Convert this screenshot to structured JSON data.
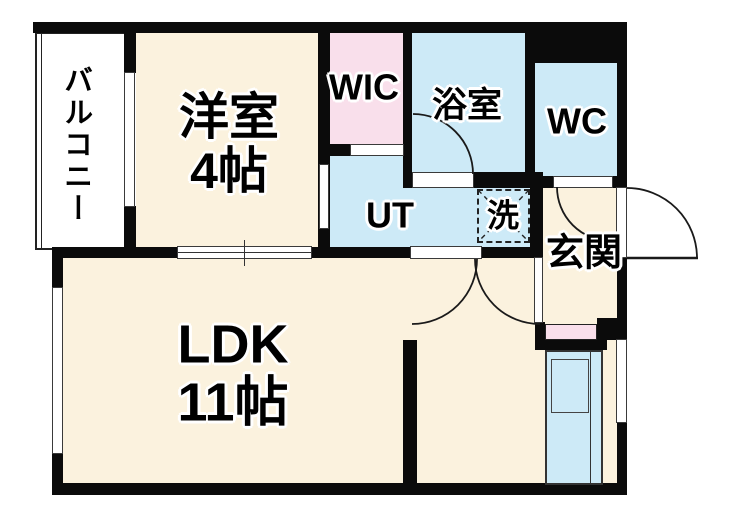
{
  "plan_title": "1LDK apartment floor plan",
  "rooms": {
    "balcony": {
      "label": "バルコニー"
    },
    "bedroom": {
      "label": "洋室",
      "size": "4帖"
    },
    "wic": {
      "label": "WIC"
    },
    "bathroom": {
      "label": "浴室"
    },
    "toilet": {
      "label": "WC"
    },
    "utility": {
      "label": "UT"
    },
    "laundry": {
      "label": "洗"
    },
    "entrance": {
      "label": "玄関"
    },
    "ldk": {
      "label": "LDK",
      "size": "11帖"
    }
  },
  "colors": {
    "wall": "#0b0b0b",
    "floor_cream": "#fbf2de",
    "closet_pink": "#f9dfeb",
    "wet_area_blue": "#cdeaf7",
    "balcony_white": "#ffffff"
  }
}
